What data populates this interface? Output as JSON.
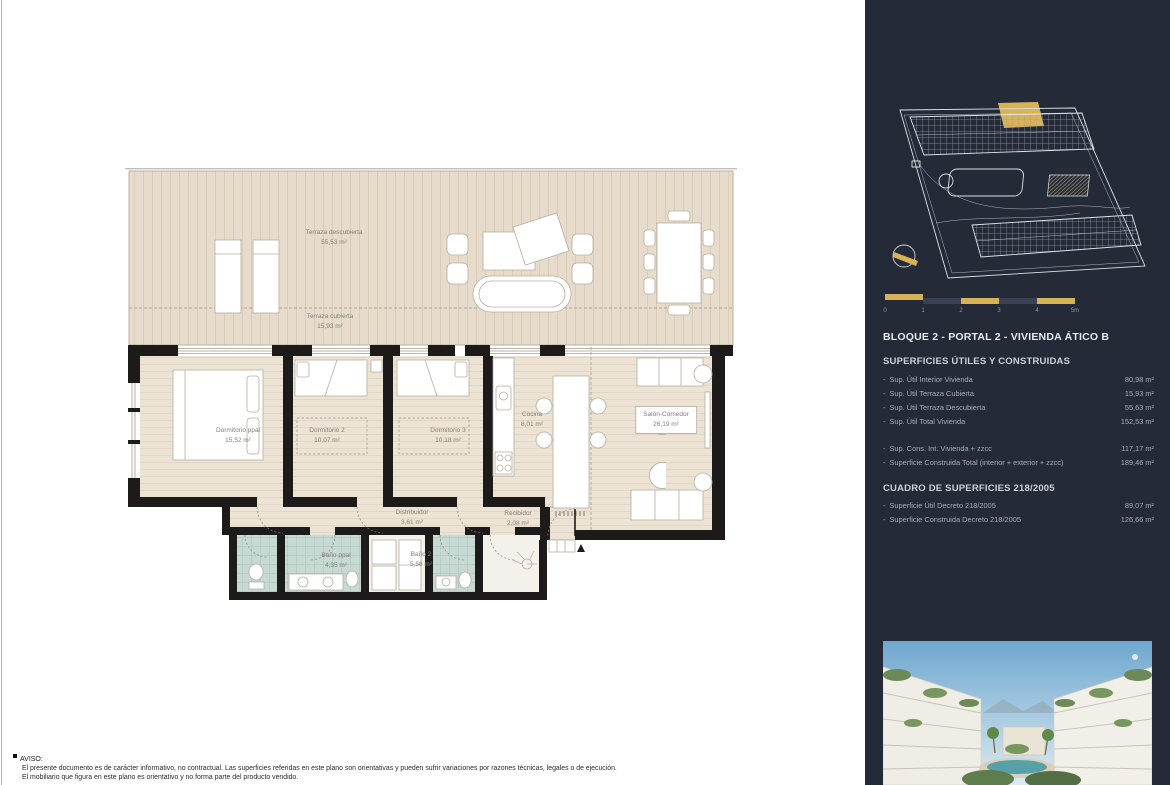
{
  "floorplan": {
    "rooms": [
      {
        "name": "Terraza descubierta",
        "area": "55,53 m²"
      },
      {
        "name": "Terraza cubierta",
        "area": "15,93 m²"
      },
      {
        "name": "Dormitorio ppal",
        "area": "15,52 m²"
      },
      {
        "name": "Dormitorio 2",
        "area": "10,07 m²"
      },
      {
        "name": "Dormitorio 3",
        "area": "10,18 m²"
      },
      {
        "name": "Cocina",
        "area": "8,01 m²"
      },
      {
        "name": "Salón-Comedor",
        "area": "26,19 m²"
      },
      {
        "name": "Distribuidor",
        "area": "3,61 m²"
      },
      {
        "name": "Recibidor",
        "area": "2,08 m²"
      },
      {
        "name": "Baño ppal",
        "area": "4,35 m²"
      },
      {
        "name": "Baño 2",
        "area": "5,56 m²"
      }
    ]
  },
  "sidebar": {
    "bg": "#242a37",
    "accent": "#d7b254",
    "title": "BLOQUE 2 - PORTAL 2 - VIVIENDA ÁTICO B",
    "row_bullet": "-",
    "scalebar": {
      "labels": [
        "0",
        "1",
        "2",
        "3",
        "4",
        "5m"
      ]
    },
    "sections": [
      {
        "heading": "SUPERFICIES ÚTILES Y CONSTRUIDAS",
        "groups": [
          {
            "rows": [
              {
                "label": "Sup. Útil Interior Vivienda",
                "value": "80,98 m²"
              },
              {
                "label": "Sup. Útil Terraza Cubierta",
                "value": "15,93 m²"
              },
              {
                "label": "Sup. Útil Terraza Descubierta",
                "value": "55,63 m²"
              },
              {
                "label": "Sup. Útil Total Vivienda",
                "value": "152,53 m²"
              }
            ]
          },
          {
            "rows": [
              {
                "label": "Sup. Cons. Int. Vivienda + zzcc",
                "value": "117,17 m²"
              },
              {
                "label": "Superficie Construida Total (interior + exterior + zzcc)",
                "value": "189,46 m²"
              }
            ]
          }
        ]
      },
      {
        "heading": "CUADRO DE SUPERFICIES 218/2005",
        "groups": [
          {
            "rows": [
              {
                "label": "Superficie Útil Decreto 218/2005",
                "value": "89,07 m²"
              },
              {
                "label": "Superficie Construida Decreto 218/2005",
                "value": "126,66 m²"
              }
            ]
          }
        ]
      }
    ]
  },
  "disclaimer": {
    "heading": "AVISO:",
    "lines": [
      "El presente documento es de carácter informativo, no contractual. Las superficies referidas en este plano son orientativas y pueden sufrir variaciones por razones técnicas, legales o de ejecución.",
      "El mobiliario que figura en este plano es orientativo y no forma parte del producto vendido."
    ]
  }
}
